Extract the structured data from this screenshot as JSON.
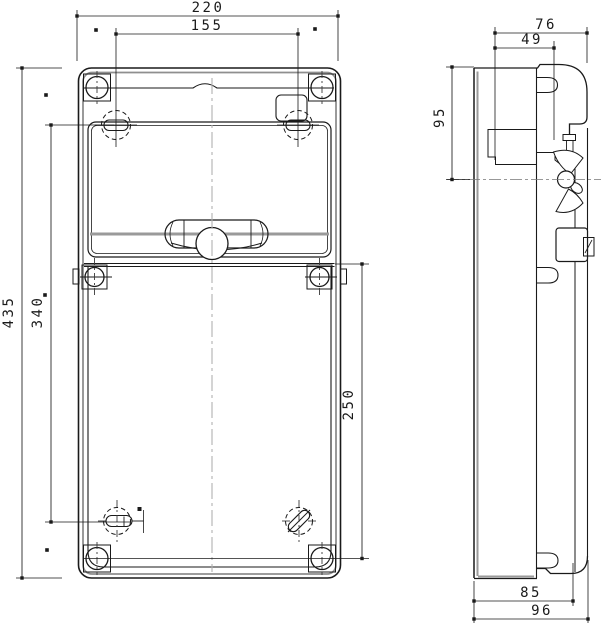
{
  "drawing": {
    "background": "#ffffff",
    "line_color": "#1a1a1a",
    "gray_line_color": "#9a9a9a",
    "centerline_color": "#b0b0b0",
    "dimensions": {
      "front_overall_width": "220",
      "front_mount_hole_spacing_x": "155",
      "front_overall_height": "435",
      "front_mount_hole_spacing_y": "340",
      "front_lower_section_height": "250",
      "side_overall_top_depth": "76",
      "side_cover_depth": "49",
      "side_upper_height": "95",
      "side_body_depth": "85",
      "side_overall_depth": "96"
    }
  }
}
